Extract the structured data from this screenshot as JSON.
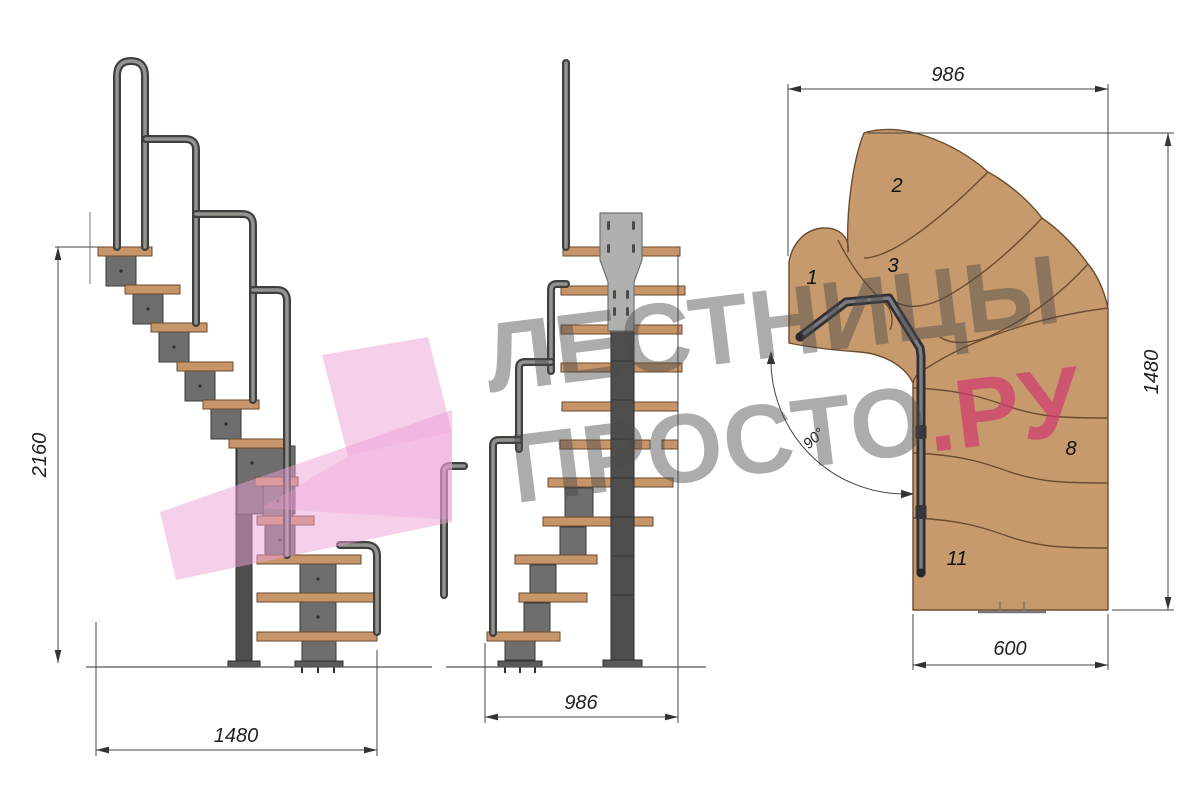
{
  "watermark": {
    "line1": "ЛЕСТНИЦЫ",
    "line2_gray": "ПРОСТО",
    "line2_pink": ".РУ"
  },
  "side_view": {
    "height_label": "2160",
    "width_label": "1480"
  },
  "front_view": {
    "width_label": "986"
  },
  "plan_view": {
    "top_width_label": "986",
    "right_height_label": "1480",
    "bottom_width_label": "600",
    "angle_label": "90°",
    "steps": [
      "1",
      "2",
      "3",
      "8",
      "11"
    ]
  },
  "colors": {
    "wood": "#c7956a",
    "metal": "#6e6e6e",
    "rail": "#7d7d7b",
    "pink_logo": "#ee9fd6",
    "watermark_gray": "#4a4a4a",
    "watermark_pink": "#d13a6f",
    "dim": "#333333"
  }
}
